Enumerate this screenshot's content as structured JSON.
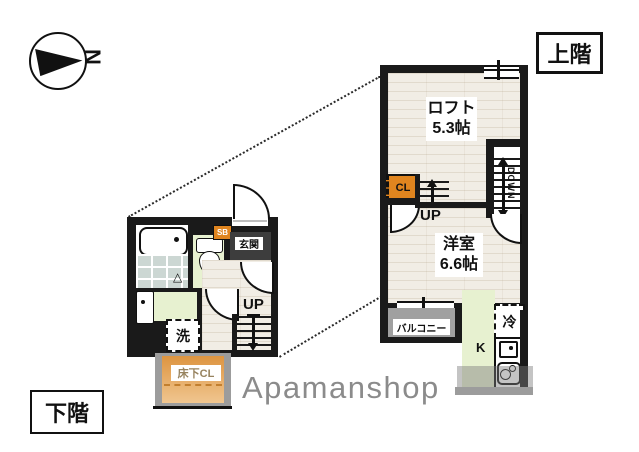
{
  "compass": {
    "north_label": "N"
  },
  "floor_tags": {
    "upper": "上階",
    "lower": "下階"
  },
  "upper_floor": {
    "loft_name": "ロフト",
    "loft_size": "5.3帖",
    "closet_label": "CL",
    "up_label": "UP",
    "down_label": "DOWN",
    "room_name": "洋室",
    "room_size": "6.6帖",
    "balcony_label": "バルコニー",
    "kitchen_label": "K",
    "fridge_label": "冷"
  },
  "lower_floor": {
    "entrance_label": "玄関",
    "shoe_box_label": "SB",
    "up_label": "UP",
    "washer_label": "洗",
    "underfloor_closet_label": "床下CL"
  },
  "icons": {
    "shower_drain": "△"
  },
  "watermark": "Apamanshop",
  "colors": {
    "wall": "#1a1a1a",
    "accent_orange": "#e0851f",
    "room_green": "#e7f1d0",
    "balcony_gray": "#9c9c9c",
    "entrance_dark": "#3d3d3d",
    "tile_blue_gray": "#ccd7d3",
    "wood_beige": "#f1ede5",
    "watermark_gray": "#8b8b8b"
  }
}
